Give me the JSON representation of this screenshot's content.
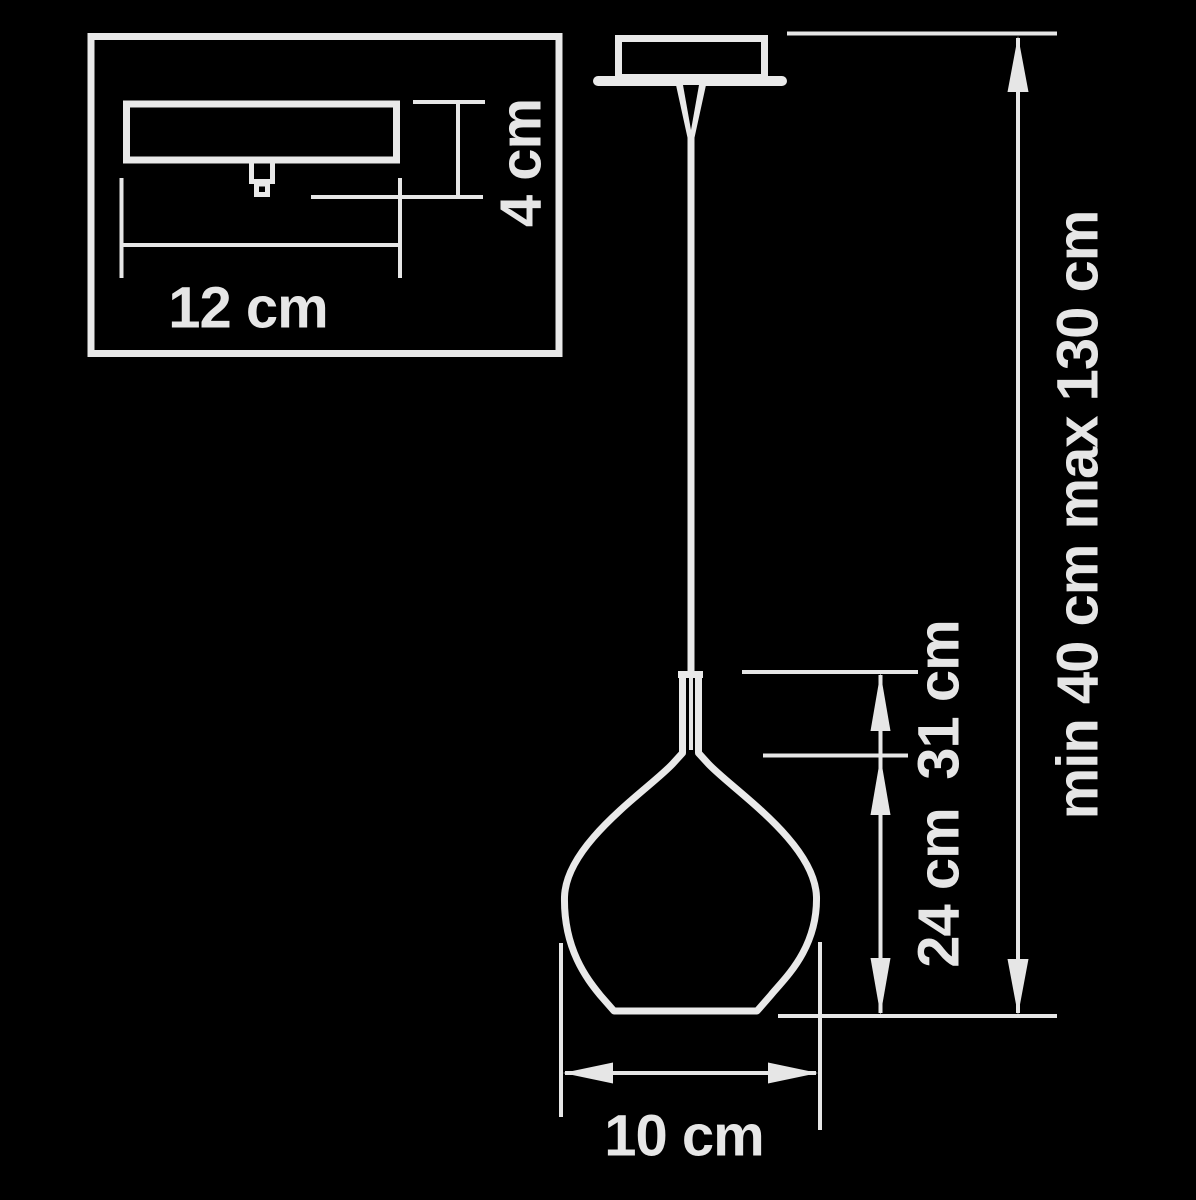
{
  "meta": {
    "description": "Pendant lamp dimension diagram",
    "colors": {
      "background": "#000000",
      "line": "#e9e9e9",
      "text": "#e6e6e6"
    }
  },
  "inset": {
    "width_label": "12 cm",
    "height_label": "4 cm"
  },
  "pendant": {
    "shade_total_height_label": "31 cm",
    "shade_body_height_label": "24 cm",
    "shade_diameter_label": "10 cm",
    "suspension_range_label": "min 40 cm max 130 cm"
  }
}
